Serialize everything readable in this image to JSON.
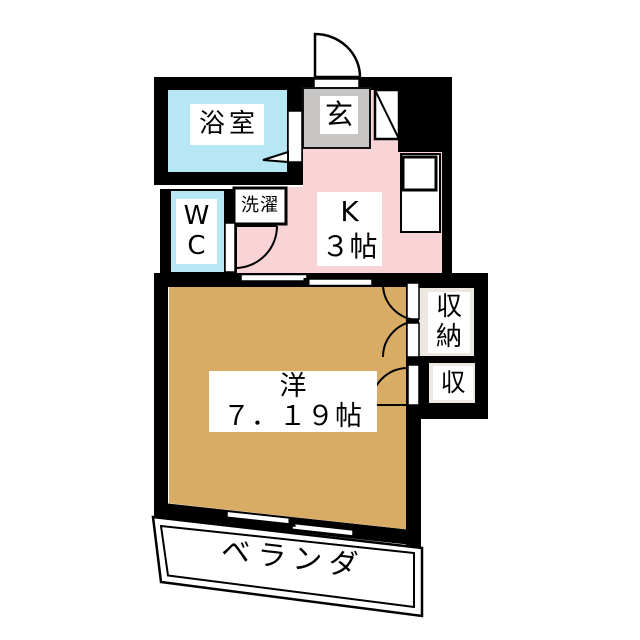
{
  "rooms": {
    "bathroom": {
      "label": "浴室"
    },
    "entrance": {
      "label": "玄"
    },
    "kitchen": {
      "label": "K",
      "size": "３帖"
    },
    "wc": {
      "chars": [
        "W",
        "C"
      ]
    },
    "laundry": {
      "label": "洗濯"
    },
    "western_room": {
      "label": "洋",
      "size": "７．１９帖"
    },
    "closet": {
      "chars": [
        "収",
        "納"
      ]
    },
    "closet_small": {
      "label": "収"
    },
    "veranda": {
      "label": "ベランダ"
    }
  },
  "colors": {
    "wall": "#000000",
    "water_blue": "#B7E6F4",
    "kitchen_pink": "#F9D4D6",
    "entrance_gray": "#C7C6C4",
    "room_tan": "#D8AC64",
    "closet_beige": "#ECE8DF",
    "label_bg": "#FFFFFF"
  }
}
